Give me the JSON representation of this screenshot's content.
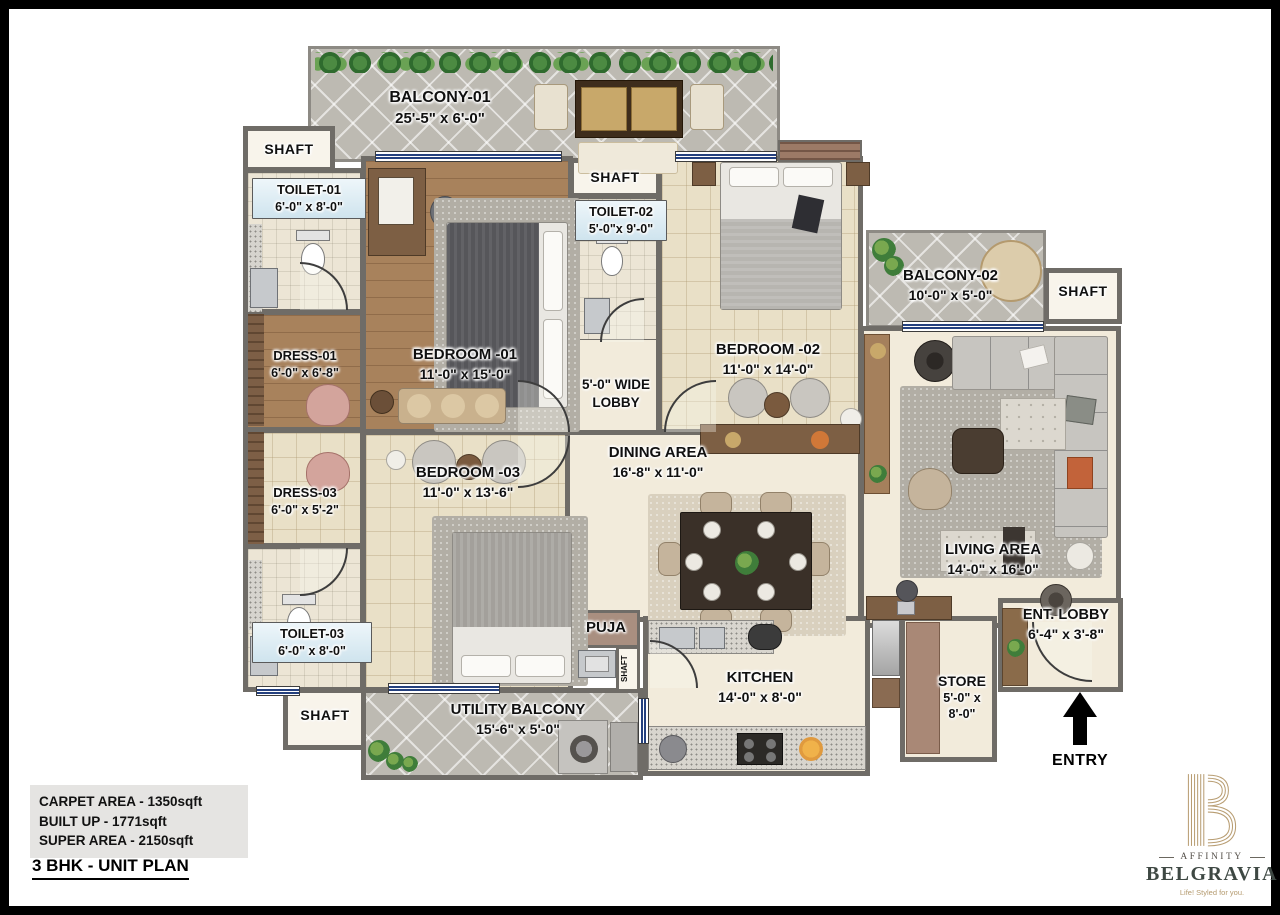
{
  "rooms": {
    "balcony01": {
      "name": "BALCONY-01",
      "dims": "25'-5\" x 6'-0\""
    },
    "shaft": {
      "label": "SHAFT"
    },
    "toilet01": {
      "name": "TOILET-01",
      "dims": "6'-0\" x 8'-0\""
    },
    "bedroom01": {
      "name": "BEDROOM -01",
      "dims": "11'-0\" x 15'-0\""
    },
    "toilet02": {
      "name": "TOILET-02",
      "dims": "5'-0\"x 9'-0\""
    },
    "bedroom02": {
      "name": "BEDROOM -02",
      "dims": "11'-0\" x 14'-0\""
    },
    "balcony02": {
      "name": "BALCONY-02",
      "dims": "10'-0\" x 5'-0\""
    },
    "dress01": {
      "name": "DRESS-01",
      "dims": "6'-0\" x 6'-8\""
    },
    "dress03": {
      "name": "DRESS-03",
      "dims": "6'-0\" x 5'-2\""
    },
    "toilet03": {
      "name": "TOILET-03",
      "dims": "6'-0\" x 8'-0\""
    },
    "bedroom03": {
      "name": "BEDROOM -03",
      "dims": "11'-0\" x 13'-6\""
    },
    "lobby": {
      "line1": "5'-0\" WIDE",
      "line2": "LOBBY"
    },
    "dining": {
      "name": "DINING AREA",
      "dims": "16'-8\" x 11'-0\""
    },
    "living": {
      "name": "LIVING AREA",
      "dims": "14'-0\" x 16'-0\""
    },
    "puja": {
      "name": "PUJA"
    },
    "kitchen": {
      "name": "KITCHEN",
      "dims": "14'-0\" x 8'-0\""
    },
    "store": {
      "name": "STORE",
      "dims1": "5'-0\" x",
      "dims2": "8'-0\""
    },
    "ent_lobby": {
      "name": "ENT. LOBBY",
      "dims": "6'-4\" x 3'-8\""
    },
    "utility": {
      "name": "UTILITY BALCONY",
      "dims": "15'-6\" x 5'-0\""
    }
  },
  "entry": {
    "label": "ENTRY"
  },
  "summary": {
    "carpet": "CARPET AREA - 1350sqft",
    "built_up": "BUILT UP - 1771sqft",
    "super_area": "SUPER AREA - 2150sqft"
  },
  "title": {
    "text": "3 BHK - UNIT PLAN"
  },
  "brand": {
    "prefix": "AFFINITY",
    "name": "BELGRAVIA",
    "tagline": "Life! Styled for you."
  },
  "colors": {
    "wall": "#6f6c67",
    "window_blue": "#24407e",
    "gold": "#b89d72"
  }
}
